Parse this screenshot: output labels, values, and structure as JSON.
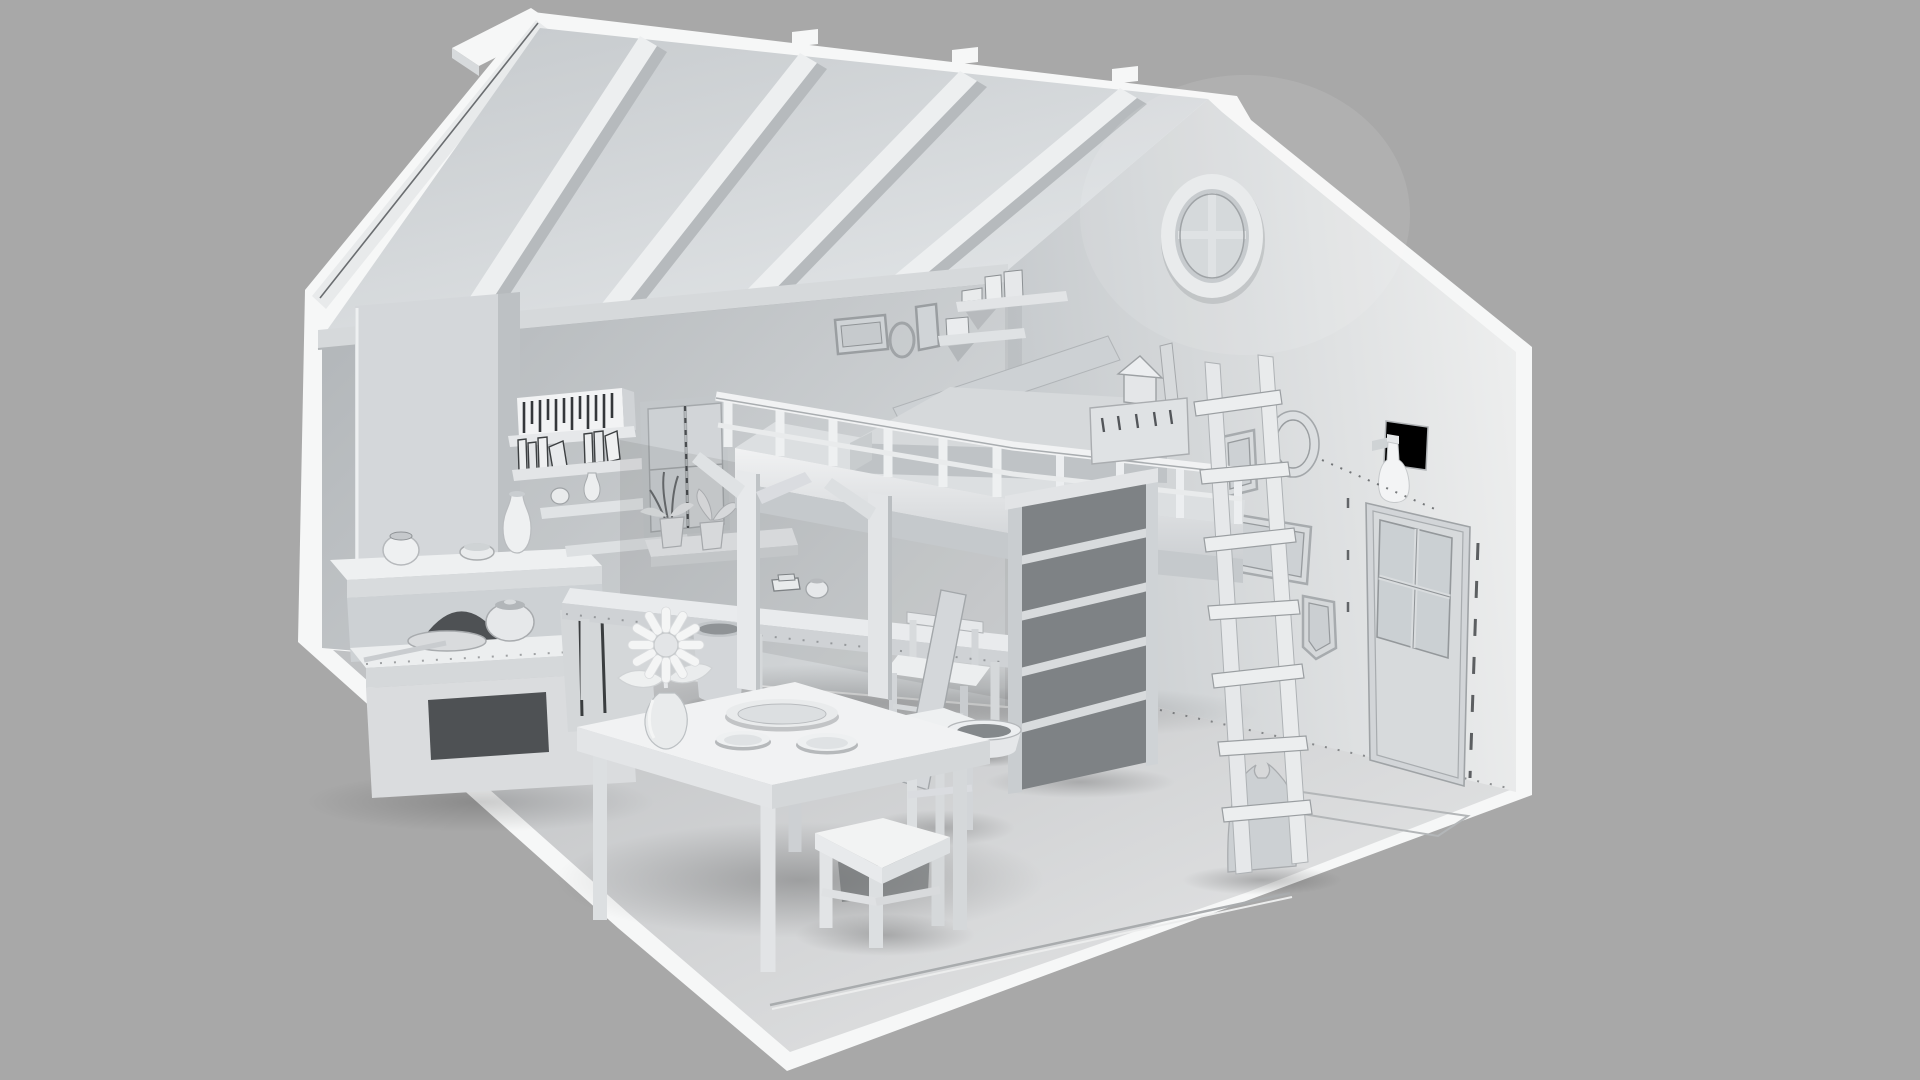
{
  "meta": {
    "scene_kind": "monochrome clay-style 3D render, attic room interior cutaway, isometric-like view",
    "visible_text": []
  },
  "palette": {
    "background": "#a8a8a8",
    "shell_white": "#f6f7f7",
    "fascia": "#e8eaeb",
    "seam_dark": "#6a6d70",
    "ceiling_top": "#c7cbce",
    "ceiling_bottom": "#e3e6e8",
    "beam_face": "#edeff0",
    "beam_side": "#b6babd",
    "plate_beam": "#d6d9db",
    "wall_left_dark": "#b4b8bb",
    "wall_left_light": "#d6d9db",
    "wall_back_dark": "#c6cacd",
    "wall_back_light": "#edeeee",
    "floor_dark": "#c0c2c4",
    "floor_light": "#dfe0e1",
    "furniture_white": "#f0f1f2",
    "furniture_mid": "#d9dcde",
    "furniture_shade": "#c2c6c9",
    "opening_dark": "#4e5154",
    "shelf_interior": "#7e8285",
    "line_dark": "#44474a"
  },
  "counts": {
    "rafters": 4,
    "railing_posts_front": 6,
    "railing_posts_side": 4,
    "ladder_rungs": 7,
    "bookshelf_shelves": 5,
    "wall_frames_right": 4,
    "wall_frames_above_bed": 3,
    "table_plates": 3,
    "stools": 2,
    "daisy_petals": 12
  },
  "inventory": [
    "sloped roof with exposed rafters",
    "round gable window with cross muntins",
    "loft bed with guard railing and mattress",
    "rustic wooden ladder",
    "tall open bookshelf under loft",
    "leaning board",
    "picture frames on walls",
    "panel door with four window panes and dashed guides",
    "wall sconce bottle lamp",
    "stone oven with arched hearth and chimney breast",
    "mantel shelf with pot, bowl and vase",
    "staggered wall shelves with books and jars",
    "slatted crate",
    "shuttered window with potted plants on sill",
    "desk with chair, book and pot",
    "cylindrical trash bin",
    "dining table with platter, two plates and daisy vase",
    "two wooden stools",
    "pet bowl",
    "grain sack",
    "small eave shelves with boxes",
    "storage crate with lantern on loft edge"
  ]
}
